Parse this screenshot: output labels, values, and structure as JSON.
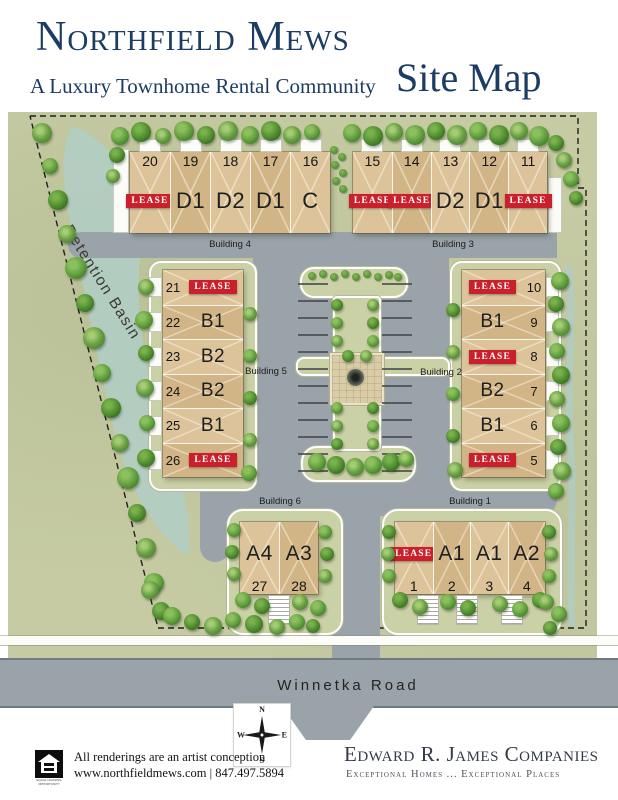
{
  "header": {
    "title": "Northfield Mews",
    "subtitle": "A Luxury Townhome Rental Community",
    "page_label": "Site Map"
  },
  "map": {
    "detention_basin": "Detention Basin",
    "winnetka_road": "Winnetka Road",
    "lease_label": "LEASE",
    "buildings": [
      {
        "id": "b4",
        "name": "Building 4",
        "units": [
          {
            "num": "20",
            "lease": true
          },
          {
            "num": "19",
            "type": "D1"
          },
          {
            "num": "18",
            "type": "D2"
          },
          {
            "num": "17",
            "type": "D1"
          },
          {
            "num": "16",
            "type": "C"
          }
        ]
      },
      {
        "id": "b3",
        "name": "Building 3",
        "units": [
          {
            "num": "15",
            "lease": true
          },
          {
            "num": "14",
            "lease": true
          },
          {
            "num": "13",
            "type": "D2"
          },
          {
            "num": "12",
            "type": "D1"
          },
          {
            "num": "11",
            "lease": true
          }
        ]
      },
      {
        "id": "b5",
        "name": "Building 5",
        "units": [
          {
            "num": "21",
            "lease": true
          },
          {
            "num": "22",
            "type": "B1"
          },
          {
            "num": "23",
            "type": "B2"
          },
          {
            "num": "24",
            "type": "B2"
          },
          {
            "num": "25",
            "type": "B1"
          },
          {
            "num": "26",
            "lease": true
          }
        ]
      },
      {
        "id": "b2",
        "name": "Building 2",
        "units": [
          {
            "num": "10",
            "lease": true
          },
          {
            "num": "9",
            "type": "B1"
          },
          {
            "num": "8",
            "lease": true
          },
          {
            "num": "7",
            "type": "B2"
          },
          {
            "num": "6",
            "type": "B1"
          },
          {
            "num": "5",
            "lease": true
          }
        ]
      },
      {
        "id": "b6",
        "name": "Building 6",
        "units": [
          {
            "num": "27",
            "type": "A4"
          },
          {
            "num": "28",
            "type": "A3"
          }
        ]
      },
      {
        "id": "b1",
        "name": "Building 1",
        "units": [
          {
            "num": "1",
            "lease": true
          },
          {
            "num": "2",
            "type": "A1"
          },
          {
            "num": "3",
            "type": "A1"
          },
          {
            "num": "4",
            "type": "A2"
          }
        ]
      }
    ],
    "trees": [
      [
        120,
        136,
        9
      ],
      [
        141,
        132,
        10
      ],
      [
        163,
        136,
        8
      ],
      [
        184,
        131,
        10
      ],
      [
        206,
        135,
        9
      ],
      [
        228,
        131,
        10
      ],
      [
        250,
        135,
        9
      ],
      [
        271,
        131,
        10
      ],
      [
        292,
        135,
        9
      ],
      [
        312,
        132,
        8
      ],
      [
        117,
        155,
        8
      ],
      [
        113,
        176,
        7
      ],
      [
        352,
        133,
        9
      ],
      [
        373,
        136,
        10
      ],
      [
        394,
        132,
        9
      ],
      [
        415,
        135,
        10
      ],
      [
        436,
        131,
        9
      ],
      [
        457,
        135,
        10
      ],
      [
        478,
        131,
        9
      ],
      [
        499,
        135,
        10
      ],
      [
        519,
        131,
        9
      ],
      [
        539,
        136,
        10
      ],
      [
        556,
        143,
        8
      ],
      [
        564,
        160,
        8
      ],
      [
        571,
        179,
        8
      ],
      [
        576,
        198,
        7
      ],
      [
        42,
        133,
        10
      ],
      [
        50,
        166,
        8
      ],
      [
        58,
        200,
        10
      ],
      [
        67,
        234,
        9
      ],
      [
        76,
        268,
        11
      ],
      [
        85,
        303,
        9
      ],
      [
        94,
        338,
        11
      ],
      [
        102,
        373,
        9
      ],
      [
        111,
        408,
        10
      ],
      [
        120,
        443,
        9
      ],
      [
        128,
        478,
        11
      ],
      [
        137,
        513,
        9
      ],
      [
        146,
        548,
        10
      ],
      [
        154,
        583,
        10
      ],
      [
        161,
        611,
        9
      ],
      [
        146,
        287,
        8
      ],
      [
        144,
        320,
        9
      ],
      [
        146,
        353,
        8
      ],
      [
        145,
        388,
        9
      ],
      [
        147,
        423,
        8
      ],
      [
        146,
        458,
        9
      ],
      [
        250,
        314,
        7
      ],
      [
        250,
        356,
        7
      ],
      [
        250,
        398,
        7
      ],
      [
        250,
        440,
        7
      ],
      [
        249,
        473,
        8
      ],
      [
        453,
        310,
        7
      ],
      [
        453,
        352,
        7
      ],
      [
        453,
        394,
        7
      ],
      [
        453,
        436,
        7
      ],
      [
        455,
        470,
        8
      ],
      [
        560,
        281,
        9
      ],
      [
        556,
        304,
        8
      ],
      [
        561,
        327,
        9
      ],
      [
        557,
        351,
        8
      ],
      [
        561,
        375,
        9
      ],
      [
        557,
        399,
        8
      ],
      [
        561,
        423,
        9
      ],
      [
        558,
        447,
        8
      ],
      [
        562,
        471,
        9
      ],
      [
        556,
        491,
        8
      ],
      [
        337,
        305,
        6
      ],
      [
        373,
        305,
        6
      ],
      [
        337,
        323,
        6
      ],
      [
        373,
        323,
        6
      ],
      [
        337,
        341,
        6
      ],
      [
        373,
        341,
        6
      ],
      [
        348,
        356,
        6
      ],
      [
        366,
        356,
        6
      ],
      [
        337,
        408,
        6
      ],
      [
        373,
        408,
        6
      ],
      [
        337,
        426,
        6
      ],
      [
        373,
        426,
        6
      ],
      [
        337,
        444,
        6
      ],
      [
        373,
        444,
        6
      ],
      [
        317,
        462,
        9
      ],
      [
        336,
        465,
        9
      ],
      [
        355,
        467,
        9
      ],
      [
        373,
        465,
        9
      ],
      [
        391,
        462,
        9
      ],
      [
        406,
        459,
        8
      ],
      [
        234,
        530,
        7
      ],
      [
        232,
        552,
        7
      ],
      [
        234,
        574,
        7
      ],
      [
        325,
        532,
        7
      ],
      [
        327,
        554,
        7
      ],
      [
        325,
        576,
        7
      ],
      [
        243,
        600,
        8
      ],
      [
        262,
        606,
        8
      ],
      [
        300,
        602,
        8
      ],
      [
        318,
        608,
        8
      ],
      [
        389,
        532,
        7
      ],
      [
        388,
        554,
        7
      ],
      [
        389,
        576,
        7
      ],
      [
        549,
        532,
        7
      ],
      [
        551,
        554,
        7
      ],
      [
        549,
        576,
        7
      ],
      [
        400,
        600,
        8
      ],
      [
        420,
        607,
        8
      ],
      [
        448,
        602,
        8
      ],
      [
        468,
        608,
        8
      ],
      [
        500,
        604,
        8
      ],
      [
        520,
        609,
        8
      ],
      [
        540,
        600,
        8
      ],
      [
        150,
        590,
        9
      ],
      [
        172,
        616,
        9
      ],
      [
        192,
        622,
        8
      ],
      [
        213,
        626,
        9
      ],
      [
        233,
        620,
        8
      ],
      [
        254,
        624,
        9
      ],
      [
        277,
        627,
        8
      ],
      [
        297,
        622,
        8
      ],
      [
        313,
        626,
        7
      ],
      [
        546,
        602,
        8
      ],
      [
        559,
        614,
        8
      ],
      [
        550,
        628,
        7
      ]
    ],
    "shrubs": [
      [
        334,
        150
      ],
      [
        342,
        157
      ],
      [
        335,
        165
      ],
      [
        343,
        173
      ],
      [
        336,
        181
      ],
      [
        343,
        189
      ],
      [
        312,
        276
      ],
      [
        323,
        274
      ],
      [
        334,
        277
      ],
      [
        345,
        274
      ],
      [
        356,
        277
      ],
      [
        367,
        274
      ],
      [
        378,
        277
      ],
      [
        389,
        275
      ],
      [
        398,
        277
      ]
    ]
  },
  "compass": {
    "n": "N",
    "e": "E",
    "s": "S",
    "w": "W"
  },
  "footer": {
    "disclaimer": "All renderings are an artist conception",
    "contact": "www.northfieldmews.com | 847.497.5894",
    "equal_housing": "EQUAL HOUSING OPPORTUNITY",
    "company": "Edward R. James Companies",
    "tagline": "Exceptional Homes ... Exceptional Places"
  },
  "colors": {
    "navy": "#1d3c63",
    "lease_red": "#c9202b",
    "map_green": "#c6cba3",
    "road_gray": "#9aa3a9",
    "water": "#b2cec7"
  }
}
